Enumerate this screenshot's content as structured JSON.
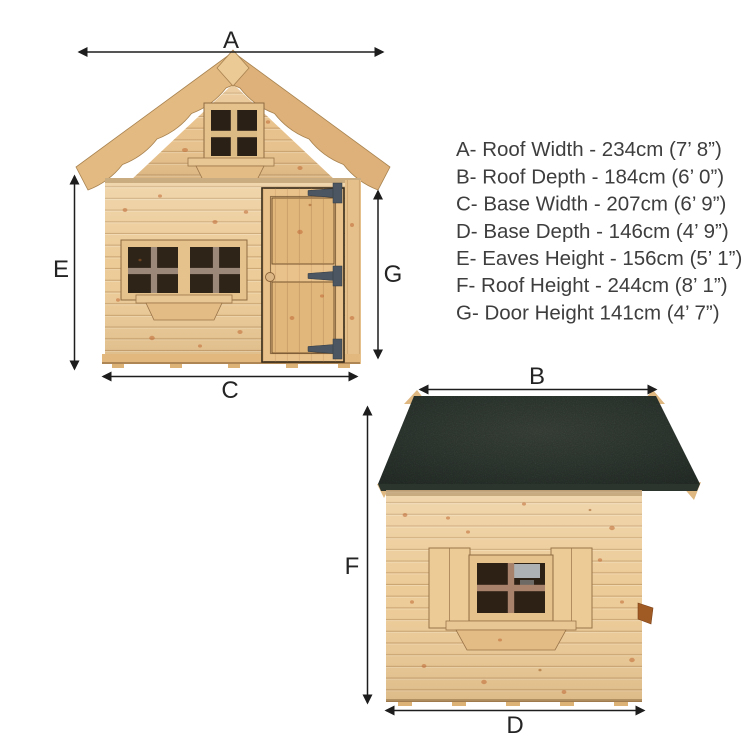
{
  "colors": {
    "background": "#ffffff",
    "wood_light": "#eccf9e",
    "wood_frame": "#e5c18c",
    "wood_shadow": "#c3a06c",
    "roof_felt_green": "#39433c",
    "window_glass": "#2e2217",
    "lower_mullion_gray": "#9b8878",
    "side_mullion_brown": "#a8826a",
    "hinge_gray": "#4b5662",
    "arrow_black": "#1d1d1d",
    "legend_text": "#3e3e3e"
  },
  "legend": {
    "entries": [
      {
        "letter": "A",
        "text": "A- Roof Width - 234cm (7’ 8”)"
      },
      {
        "letter": "B",
        "text": "B- Roof Depth - 184cm (6’ 0”)"
      },
      {
        "letter": "C",
        "text": "C- Base Width - 207cm (6’ 9”)"
      },
      {
        "letter": "D",
        "text": "D- Base Depth - 146cm (4’ 9”)"
      },
      {
        "letter": "E",
        "text": "E- Eaves Height - 156cm (5’ 1”)"
      },
      {
        "letter": "F",
        "text": "F- Roof Height - 244cm (8’ 1”)"
      },
      {
        "letter": "G",
        "text": "G- Door Height 141cm (4’ 7”)"
      }
    ]
  }
}
